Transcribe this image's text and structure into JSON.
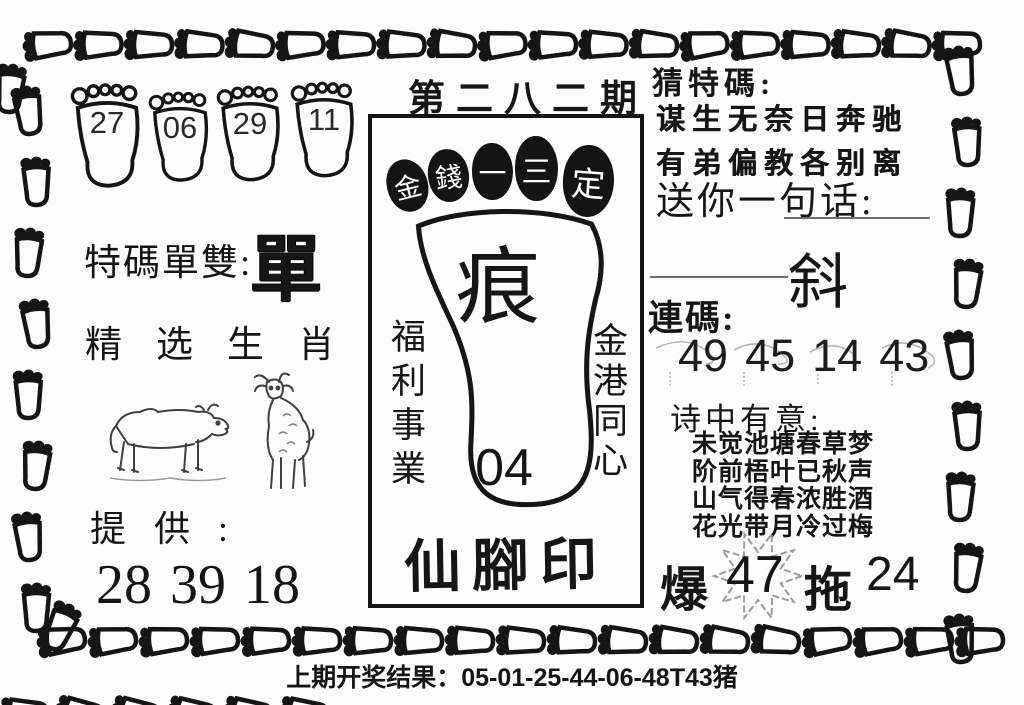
{
  "issue_title": "第二八二期",
  "top_feet": [
    "27",
    "06",
    "29",
    "11"
  ],
  "left": {
    "odd_even_label": "特碼單雙:",
    "odd_even_value": "單",
    "zodiac_title": "精选生肖",
    "provide_label": "提供:",
    "provide_numbers": [
      "28",
      "39",
      "18"
    ]
  },
  "center": {
    "toe_chars": [
      "金",
      "錢",
      "一",
      "三",
      "定"
    ],
    "foot_char": "痕",
    "foot_number": "04",
    "left_vertical": "福利事業",
    "right_vertical": "金港同心",
    "bottom_title": "仙腳印"
  },
  "right": {
    "guess_label": "猜特碼:",
    "verse_line1": "谋生无奈日奔驰",
    "verse_line2": "有弟偏教各别离",
    "message_label": "送你一句话:",
    "message_value": "斜",
    "lianma_label": "連碼:",
    "lianma_numbers": [
      "49",
      "45",
      "14",
      "43"
    ],
    "poem_label": "诗中有意:",
    "poem_lines": [
      "未觉池塘春草梦",
      "阶前梧叶已秋声",
      "山气得春浓胜酒",
      "花光带月冷过梅"
    ],
    "bao_label": "爆",
    "bao_number": "47",
    "tuo_label": "拖",
    "tuo_number": "24"
  },
  "footer": "上期开奖结果：05-01-25-44-06-48T43猪",
  "colors": {
    "ink": "#141414",
    "faint": "#9a9a9a"
  }
}
